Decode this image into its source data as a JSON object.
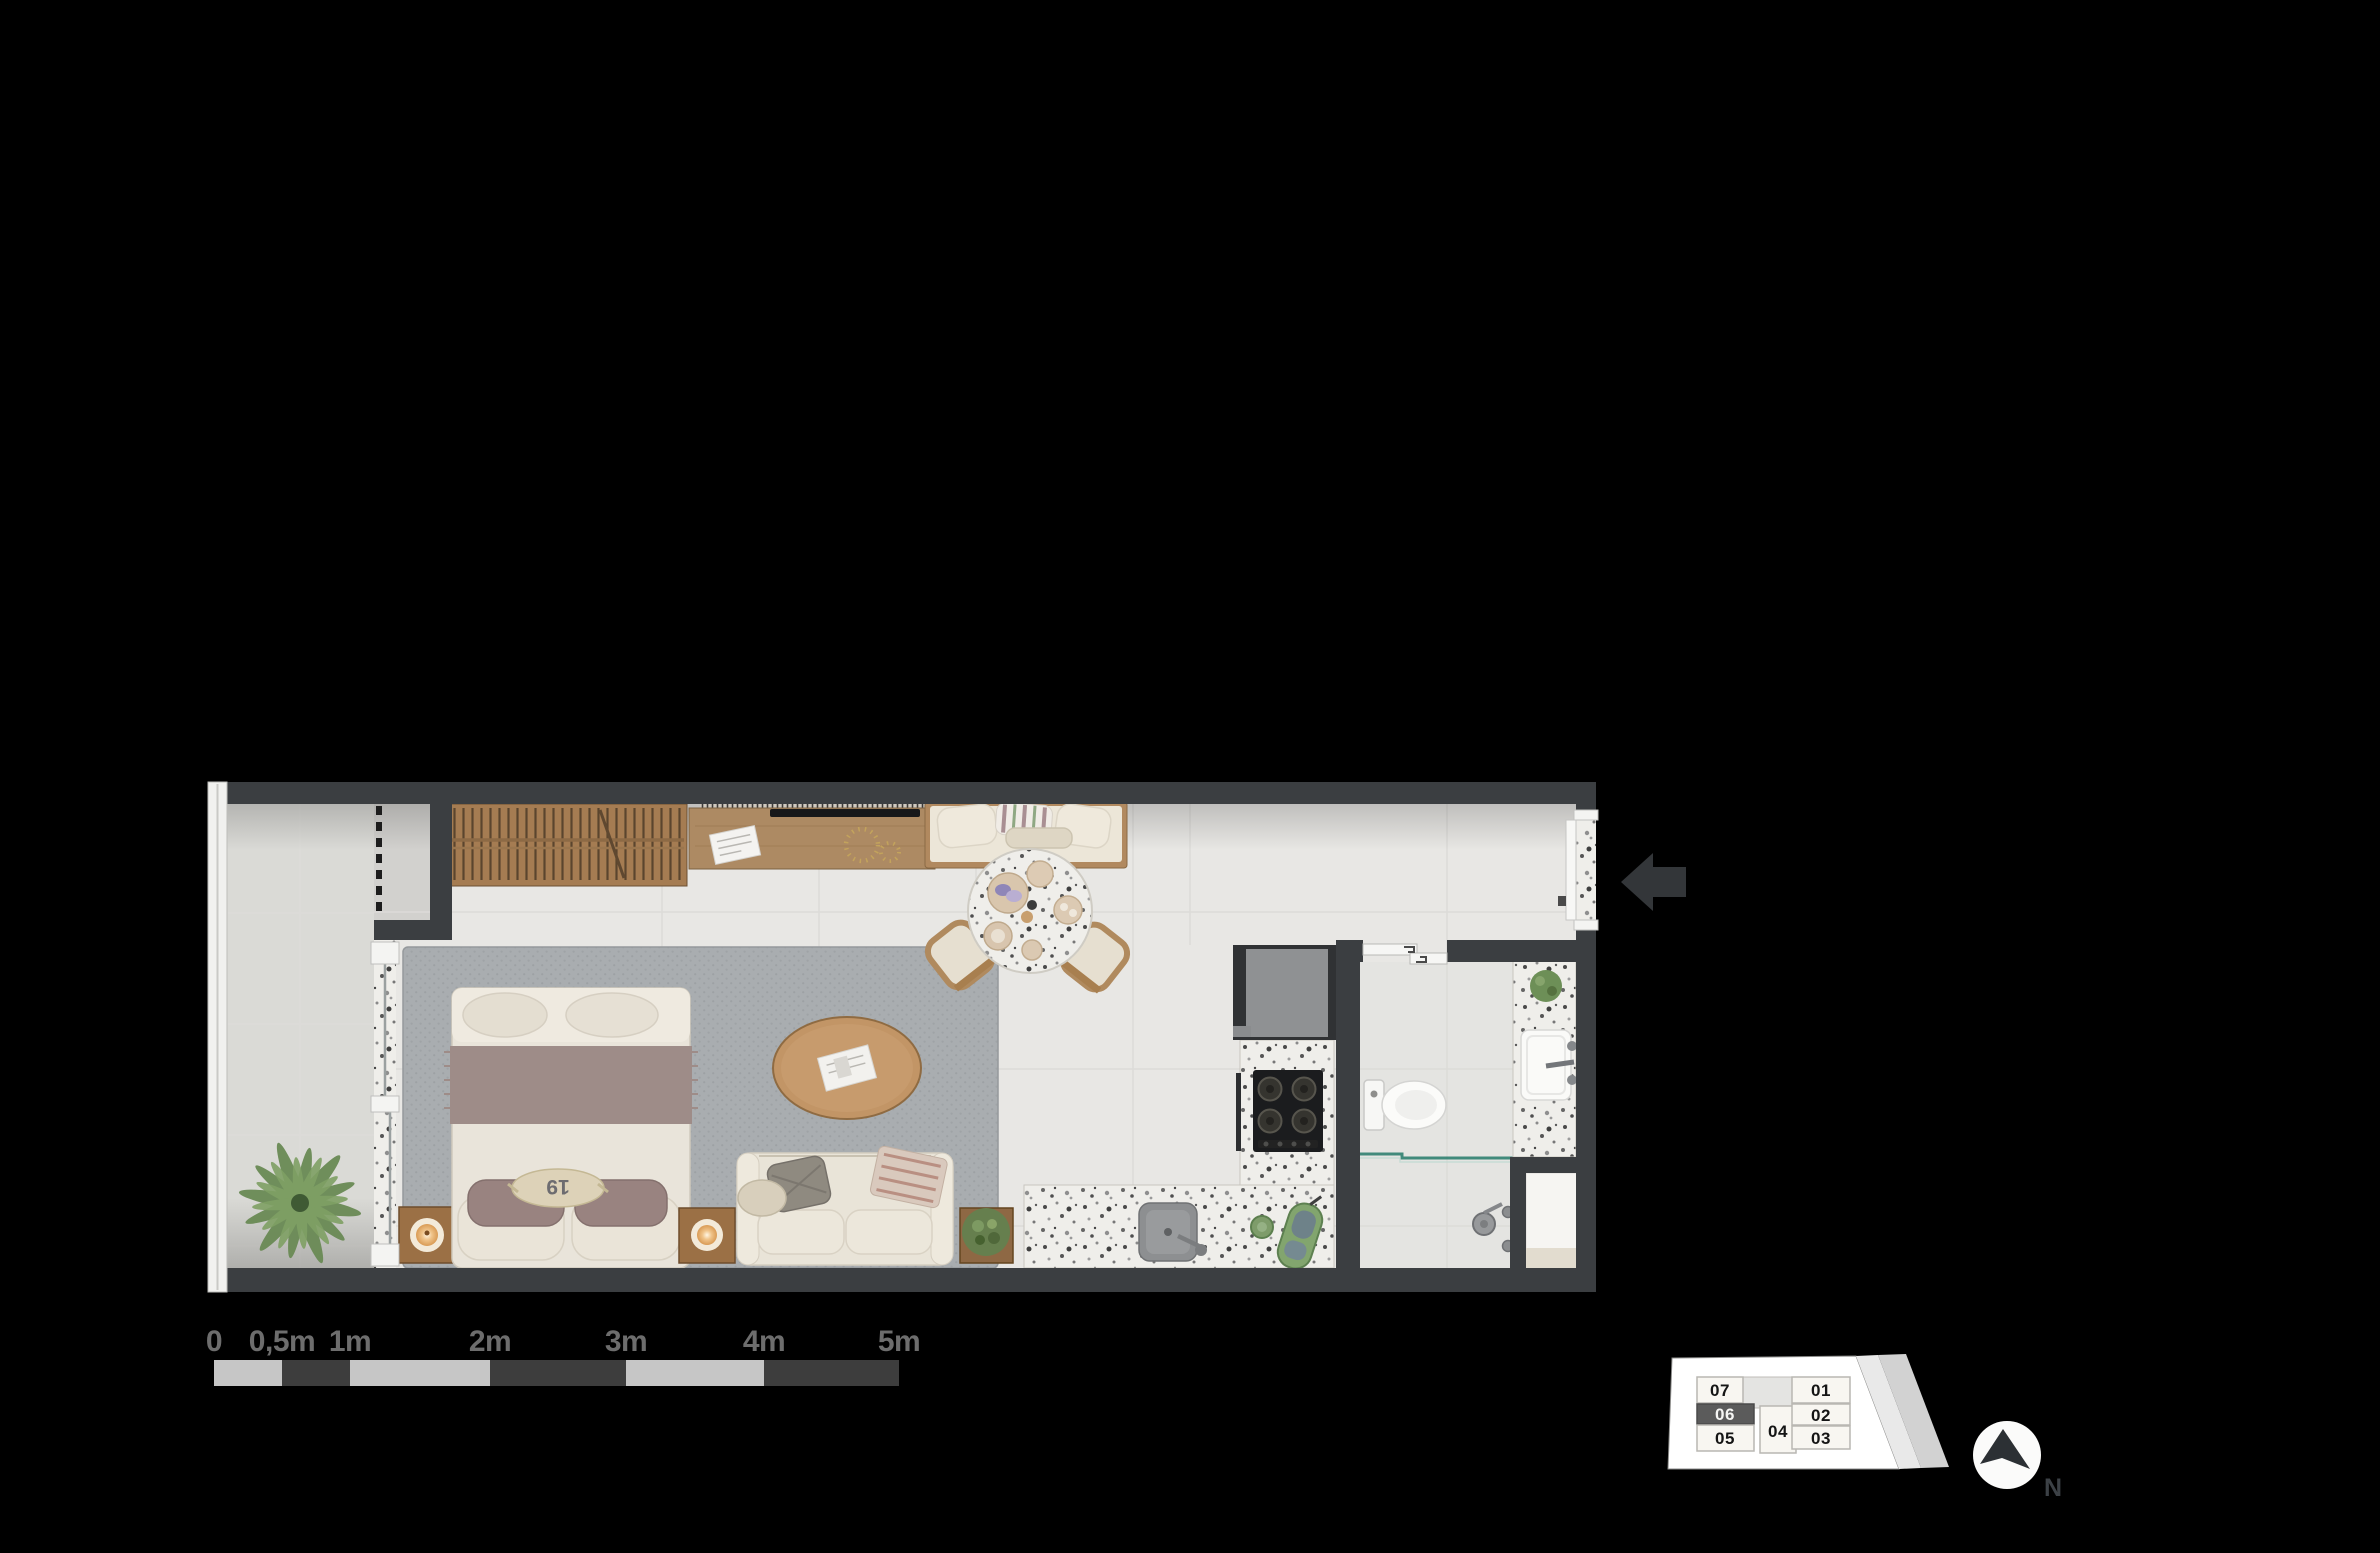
{
  "colors": {
    "background": "#000000",
    "wall": "#3b3e41",
    "interior_floor": "#e8e7e4",
    "balcony_floor": "#dadad6",
    "bathroom_floor": "#e4e4e1",
    "rug": "#a9adb0",
    "wood": "#ad8a63",
    "terrazzo_base": "#efeeea",
    "upholstery": "#e9e4d8",
    "accent_mauve": "#9e8c88",
    "plant_green": "#667f4e",
    "shower_glass": "#2f7f70",
    "scale_bar_light": "#c6c6c6",
    "scale_bar_dark": "#3d3d3d",
    "key_plan_highlight": "#5b5b5b",
    "entry_arrow": "#333639"
  },
  "scale_bar": {
    "labels": [
      "0",
      "0,5m",
      "1m",
      "2m",
      "3m",
      "4m",
      "5m"
    ]
  },
  "key_plan": {
    "highlighted_unit": "06",
    "units": [
      {
        "label": "07"
      },
      {
        "label": "06"
      },
      {
        "label": "05"
      },
      {
        "label": "04"
      },
      {
        "label": "01"
      },
      {
        "label": "02"
      },
      {
        "label": "03"
      }
    ]
  },
  "compass": {
    "north_label": "N"
  },
  "decor": {
    "bed_pillow_monogram": "19"
  }
}
